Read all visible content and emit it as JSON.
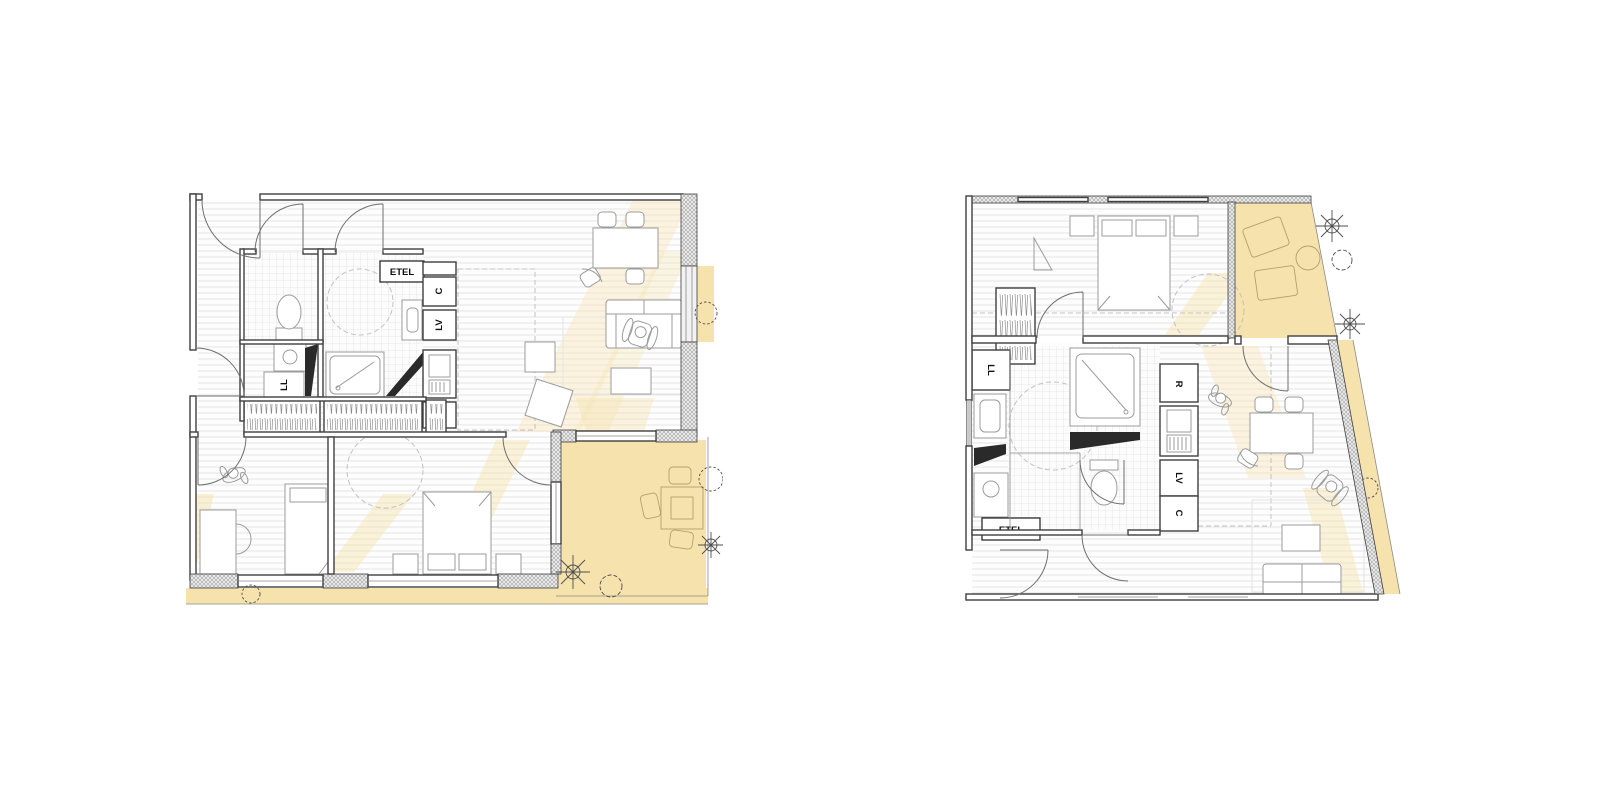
{
  "page": {
    "background": "#ffffff"
  },
  "colors": {
    "wall_line": "#3f3f3f",
    "floor_hatch": "#e3e3e3",
    "tile_grid": "#d9d9d9",
    "terrace_yellow": "#f6e2ad",
    "sun_patch_yellow": "#f6e2ad",
    "furniture_line": "#9b9b9b",
    "level_marker_black": "#2a2a2a"
  },
  "plans": {
    "left": {
      "labels": {
        "etel": "ETEL",
        "c": "C",
        "lv": "LV",
        "r": "R",
        "ll": "LL"
      }
    },
    "right": {
      "labels": {
        "etel": "ETEL",
        "c": "C",
        "lv": "LV",
        "r": "R",
        "ll": "LL"
      }
    }
  }
}
